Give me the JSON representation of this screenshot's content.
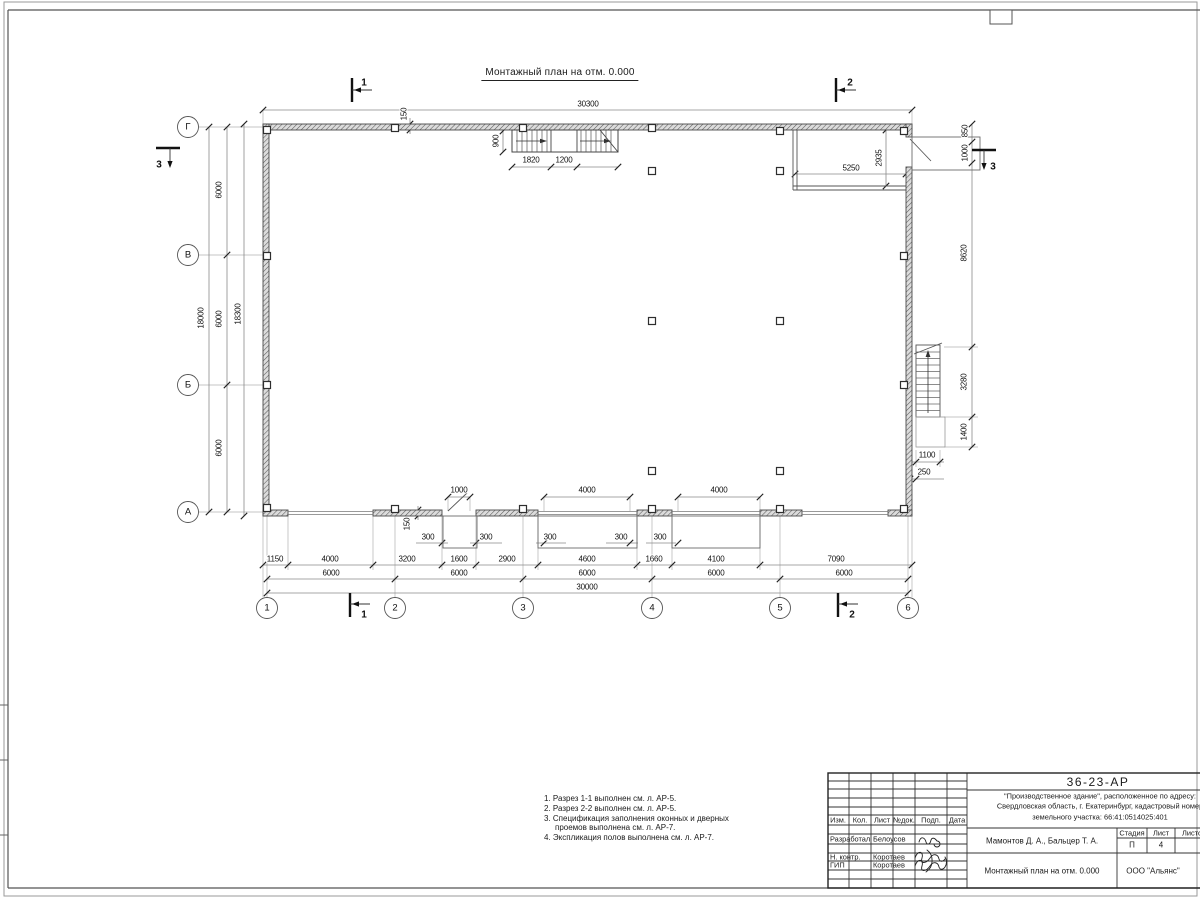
{
  "sheet": {
    "plan_title": "Монтажный план на отм. 0.000",
    "notes": [
      "1. Разрез 1-1 выполнен см. л. АР-5.",
      "2. Разрез 2-2 выполнен см. л. АР-5.",
      "3. Спецификация заполнения оконных и дверных",
      "проемов выполнена см. л. АР-7.",
      "4. Экспликация полов выполнена см. л. АР-7."
    ]
  },
  "title_block": {
    "doc_number": "36-23-АР",
    "project_line1": "\"Производственное здание\", расположенное по адресу:",
    "project_line2": "Свердловская область, г. Екатеринбург, кадастровый номер",
    "project_line3": "земельного участка: 66:41:0514025:401",
    "authors": "Мамонтов Д. А., Бальцер Т. А.",
    "drawing_title": "Монтажный план на отм. 0.000",
    "company": "ООО \"Альянс\"",
    "stage_label": "Стадия",
    "sheet_label": "Лист",
    "sheets_label": "Листов",
    "stage_value": "П",
    "sheet_value": "4",
    "cols": [
      "Изм.",
      "Кол.",
      "Лист",
      "№док.",
      "Подп.",
      "Дата"
    ],
    "roles": [
      {
        "role": "Разработал",
        "name": "Белоусов"
      },
      {
        "role": "Н. контр.",
        "name": "Коротаев"
      },
      {
        "role": "ГИП",
        "name": "Коротаев"
      }
    ]
  },
  "plan": {
    "axes_left": {
      "cx": 188,
      "r": 10.5,
      "items": [
        {
          "l": "Г",
          "y": 127
        },
        {
          "l": "В",
          "y": 255
        },
        {
          "l": "Б",
          "y": 385
        },
        {
          "l": "А",
          "y": 512
        }
      ]
    },
    "axes_bottom": {
      "cy": 608,
      "r": 10.5,
      "items": [
        {
          "l": "1",
          "x": 267
        },
        {
          "l": "2",
          "x": 395
        },
        {
          "l": "3",
          "x": 523
        },
        {
          "l": "4",
          "x": 652
        },
        {
          "l": "5",
          "x": 780
        },
        {
          "l": "6",
          "x": 908
        }
      ]
    },
    "columns": [
      [
        267,
        130
      ],
      [
        395,
        128
      ],
      [
        523,
        128
      ],
      [
        652,
        128
      ],
      [
        780,
        131
      ],
      [
        904,
        131
      ],
      [
        267,
        256
      ],
      [
        267,
        385
      ],
      [
        267,
        508
      ],
      [
        395,
        509
      ],
      [
        523,
        509
      ],
      [
        652,
        509
      ],
      [
        780,
        509
      ],
      [
        904,
        509
      ],
      [
        904,
        256
      ],
      [
        904,
        385
      ],
      [
        652,
        171
      ],
      [
        780,
        171
      ],
      [
        652,
        321
      ],
      [
        780,
        321
      ],
      [
        652,
        471
      ],
      [
        780,
        471
      ]
    ],
    "dim_lines": [
      {
        "o": "h",
        "y": 110,
        "x1": 263,
        "x2": 912,
        "t": [
          263,
          912
        ]
      },
      {
        "o": "h",
        "y": 167,
        "x1": 512,
        "x2": 618,
        "t": [
          512,
          551,
          577,
          618
        ]
      },
      {
        "o": "v",
        "x": 503,
        "y1": 131,
        "y2": 152,
        "t": [
          131,
          152
        ]
      },
      {
        "o": "v",
        "x": 410,
        "y1": 118,
        "y2": 134,
        "t": [
          124,
          130
        ]
      },
      {
        "o": "v",
        "x": 972,
        "y1": 124,
        "y2": 447,
        "t": [
          124,
          142,
          163,
          347,
          417,
          447
        ]
      },
      {
        "o": "h",
        "y": 174,
        "x1": 795,
        "x2": 906,
        "t": [
          795,
          906
        ]
      },
      {
        "o": "v",
        "x": 886,
        "y1": 130,
        "y2": 186,
        "t": [
          130,
          186
        ]
      },
      {
        "o": "h",
        "y": 462,
        "x1": 912,
        "x2": 944,
        "t": [
          916,
          940
        ]
      },
      {
        "o": "h",
        "y": 479,
        "x1": 906,
        "x2": 944,
        "t": [
          910,
          916
        ]
      },
      {
        "o": "v",
        "x": 209,
        "y1": 127,
        "y2": 512,
        "t": [
          127,
          512
        ]
      },
      {
        "o": "v",
        "x": 227,
        "y1": 127,
        "y2": 512,
        "t": [
          127,
          255,
          385,
          512
        ]
      },
      {
        "o": "v",
        "x": 244,
        "y1": 124,
        "y2": 516,
        "t": [
          124,
          516
        ]
      },
      {
        "o": "h",
        "y": 497,
        "x1": 448,
        "x2": 470,
        "t": [
          448,
          470
        ]
      },
      {
        "o": "h",
        "y": 497,
        "x1": 544,
        "x2": 630,
        "t": [
          544,
          630
        ]
      },
      {
        "o": "h",
        "y": 497,
        "x1": 678,
        "x2": 760,
        "t": [
          678,
          760
        ]
      },
      {
        "o": "h",
        "y": 565,
        "x1": 263,
        "x2": 912,
        "t": [
          263,
          288,
          373,
          442,
          476,
          538,
          637,
          672,
          760,
          912
        ]
      },
      {
        "o": "h",
        "y": 579,
        "x1": 267,
        "x2": 908,
        "t": [
          267,
          395,
          523,
          652,
          780,
          908
        ]
      },
      {
        "o": "h",
        "y": 593,
        "x1": 267,
        "x2": 908,
        "t": [
          267,
          908
        ]
      },
      {
        "o": "h",
        "y": 543,
        "x1": 416,
        "x2": 448,
        "t": [
          442
        ]
      },
      {
        "o": "h",
        "y": 543,
        "x1": 470,
        "x2": 502,
        "t": [
          476
        ]
      },
      {
        "o": "h",
        "y": 543,
        "x1": 536,
        "x2": 566,
        "t": [
          544
        ]
      },
      {
        "o": "h",
        "y": 543,
        "x1": 606,
        "x2": 638,
        "t": [
          630
        ]
      },
      {
        "o": "h",
        "y": 543,
        "x1": 646,
        "x2": 676,
        "t": [
          678
        ]
      },
      {
        "o": "v",
        "x": 418,
        "y1": 506,
        "y2": 520,
        "t": [
          510,
          516
        ]
      }
    ],
    "labels": [
      {
        "t": "30300",
        "x": 588,
        "y": 104
      },
      {
        "t": "150",
        "x": 404,
        "y": 114,
        "r": -90
      },
      {
        "t": "900",
        "x": 496,
        "y": 141,
        "r": -90
      },
      {
        "t": "1820",
        "x": 531,
        "y": 160
      },
      {
        "t": "1200",
        "x": 564,
        "y": 160
      },
      {
        "t": "5250",
        "x": 851,
        "y": 168
      },
      {
        "t": "2935",
        "x": 879,
        "y": 158,
        "r": -90
      },
      {
        "t": "850",
        "x": 965,
        "y": 131,
        "r": -90
      },
      {
        "t": "1000",
        "x": 965,
        "y": 153,
        "r": -90
      },
      {
        "t": "8620",
        "x": 964,
        "y": 253,
        "r": -90
      },
      {
        "t": "3280",
        "x": 964,
        "y": 382,
        "r": -90
      },
      {
        "t": "1400",
        "x": 964,
        "y": 432,
        "r": -90
      },
      {
        "t": "1100",
        "x": 927,
        "y": 455
      },
      {
        "t": "250",
        "x": 924,
        "y": 472
      },
      {
        "t": "18000",
        "x": 201,
        "y": 318,
        "r": -90
      },
      {
        "t": "6000",
        "x": 219,
        "y": 190,
        "r": -90
      },
      {
        "t": "6000",
        "x": 219,
        "y": 319,
        "r": -90
      },
      {
        "t": "6000",
        "x": 219,
        "y": 448,
        "r": -90
      },
      {
        "t": "18300",
        "x": 238,
        "y": 314,
        "r": -90
      },
      {
        "t": "1000",
        "x": 459,
        "y": 490
      },
      {
        "t": "4000",
        "x": 587,
        "y": 490
      },
      {
        "t": "4000",
        "x": 719,
        "y": 490
      },
      {
        "t": "300",
        "x": 428,
        "y": 537
      },
      {
        "t": "300",
        "x": 486,
        "y": 537
      },
      {
        "t": "300",
        "x": 550,
        "y": 537
      },
      {
        "t": "300",
        "x": 621,
        "y": 537
      },
      {
        "t": "300",
        "x": 660,
        "y": 537
      },
      {
        "t": "150",
        "x": 407,
        "y": 524,
        "r": -90
      },
      {
        "t": "1150",
        "x": 275,
        "y": 559
      },
      {
        "t": "4000",
        "x": 330,
        "y": 559
      },
      {
        "t": "3200",
        "x": 407,
        "y": 559
      },
      {
        "t": "1600",
        "x": 459,
        "y": 559
      },
      {
        "t": "2900",
        "x": 507,
        "y": 559
      },
      {
        "t": "4600",
        "x": 587,
        "y": 559
      },
      {
        "t": "1660",
        "x": 654,
        "y": 559
      },
      {
        "t": "4100",
        "x": 716,
        "y": 559
      },
      {
        "t": "7090",
        "x": 836,
        "y": 559
      },
      {
        "t": "6000",
        "x": 331,
        "y": 573
      },
      {
        "t": "6000",
        "x": 459,
        "y": 573
      },
      {
        "t": "6000",
        "x": 587,
        "y": 573
      },
      {
        "t": "6000",
        "x": 716,
        "y": 573
      },
      {
        "t": "6000",
        "x": 844,
        "y": 573
      },
      {
        "t": "30000",
        "x": 587,
        "y": 587
      }
    ],
    "markers": [
      {
        "kind": "v",
        "x": 352,
        "y1": 78,
        "y2": 102,
        "hx": 372,
        "hy": 90,
        "l": "1",
        "lx": 364,
        "ly": 83
      },
      {
        "kind": "v",
        "x": 836,
        "y1": 78,
        "y2": 102,
        "hx": 856,
        "hy": 90,
        "l": "2",
        "lx": 850,
        "ly": 83
      },
      {
        "kind": "v",
        "x": 350,
        "y1": 593,
        "y2": 617,
        "hx": 370,
        "hy": 604,
        "l": "1",
        "lx": 364,
        "ly": 615
      },
      {
        "kind": "v",
        "x": 838,
        "y1": 593,
        "y2": 617,
        "hx": 858,
        "hy": 604,
        "l": "2",
        "lx": 852,
        "ly": 615
      },
      {
        "kind": "h",
        "y": 148,
        "x1": 156,
        "x2": 180,
        "vx": 170,
        "vy": 166,
        "l": "3",
        "lx": 159,
        "ly": 165
      },
      {
        "kind": "h",
        "y": 150,
        "x1": 972,
        "x2": 996,
        "vx": 984,
        "vy": 168,
        "l": "3",
        "lx": 993,
        "ly": 167
      }
    ]
  }
}
